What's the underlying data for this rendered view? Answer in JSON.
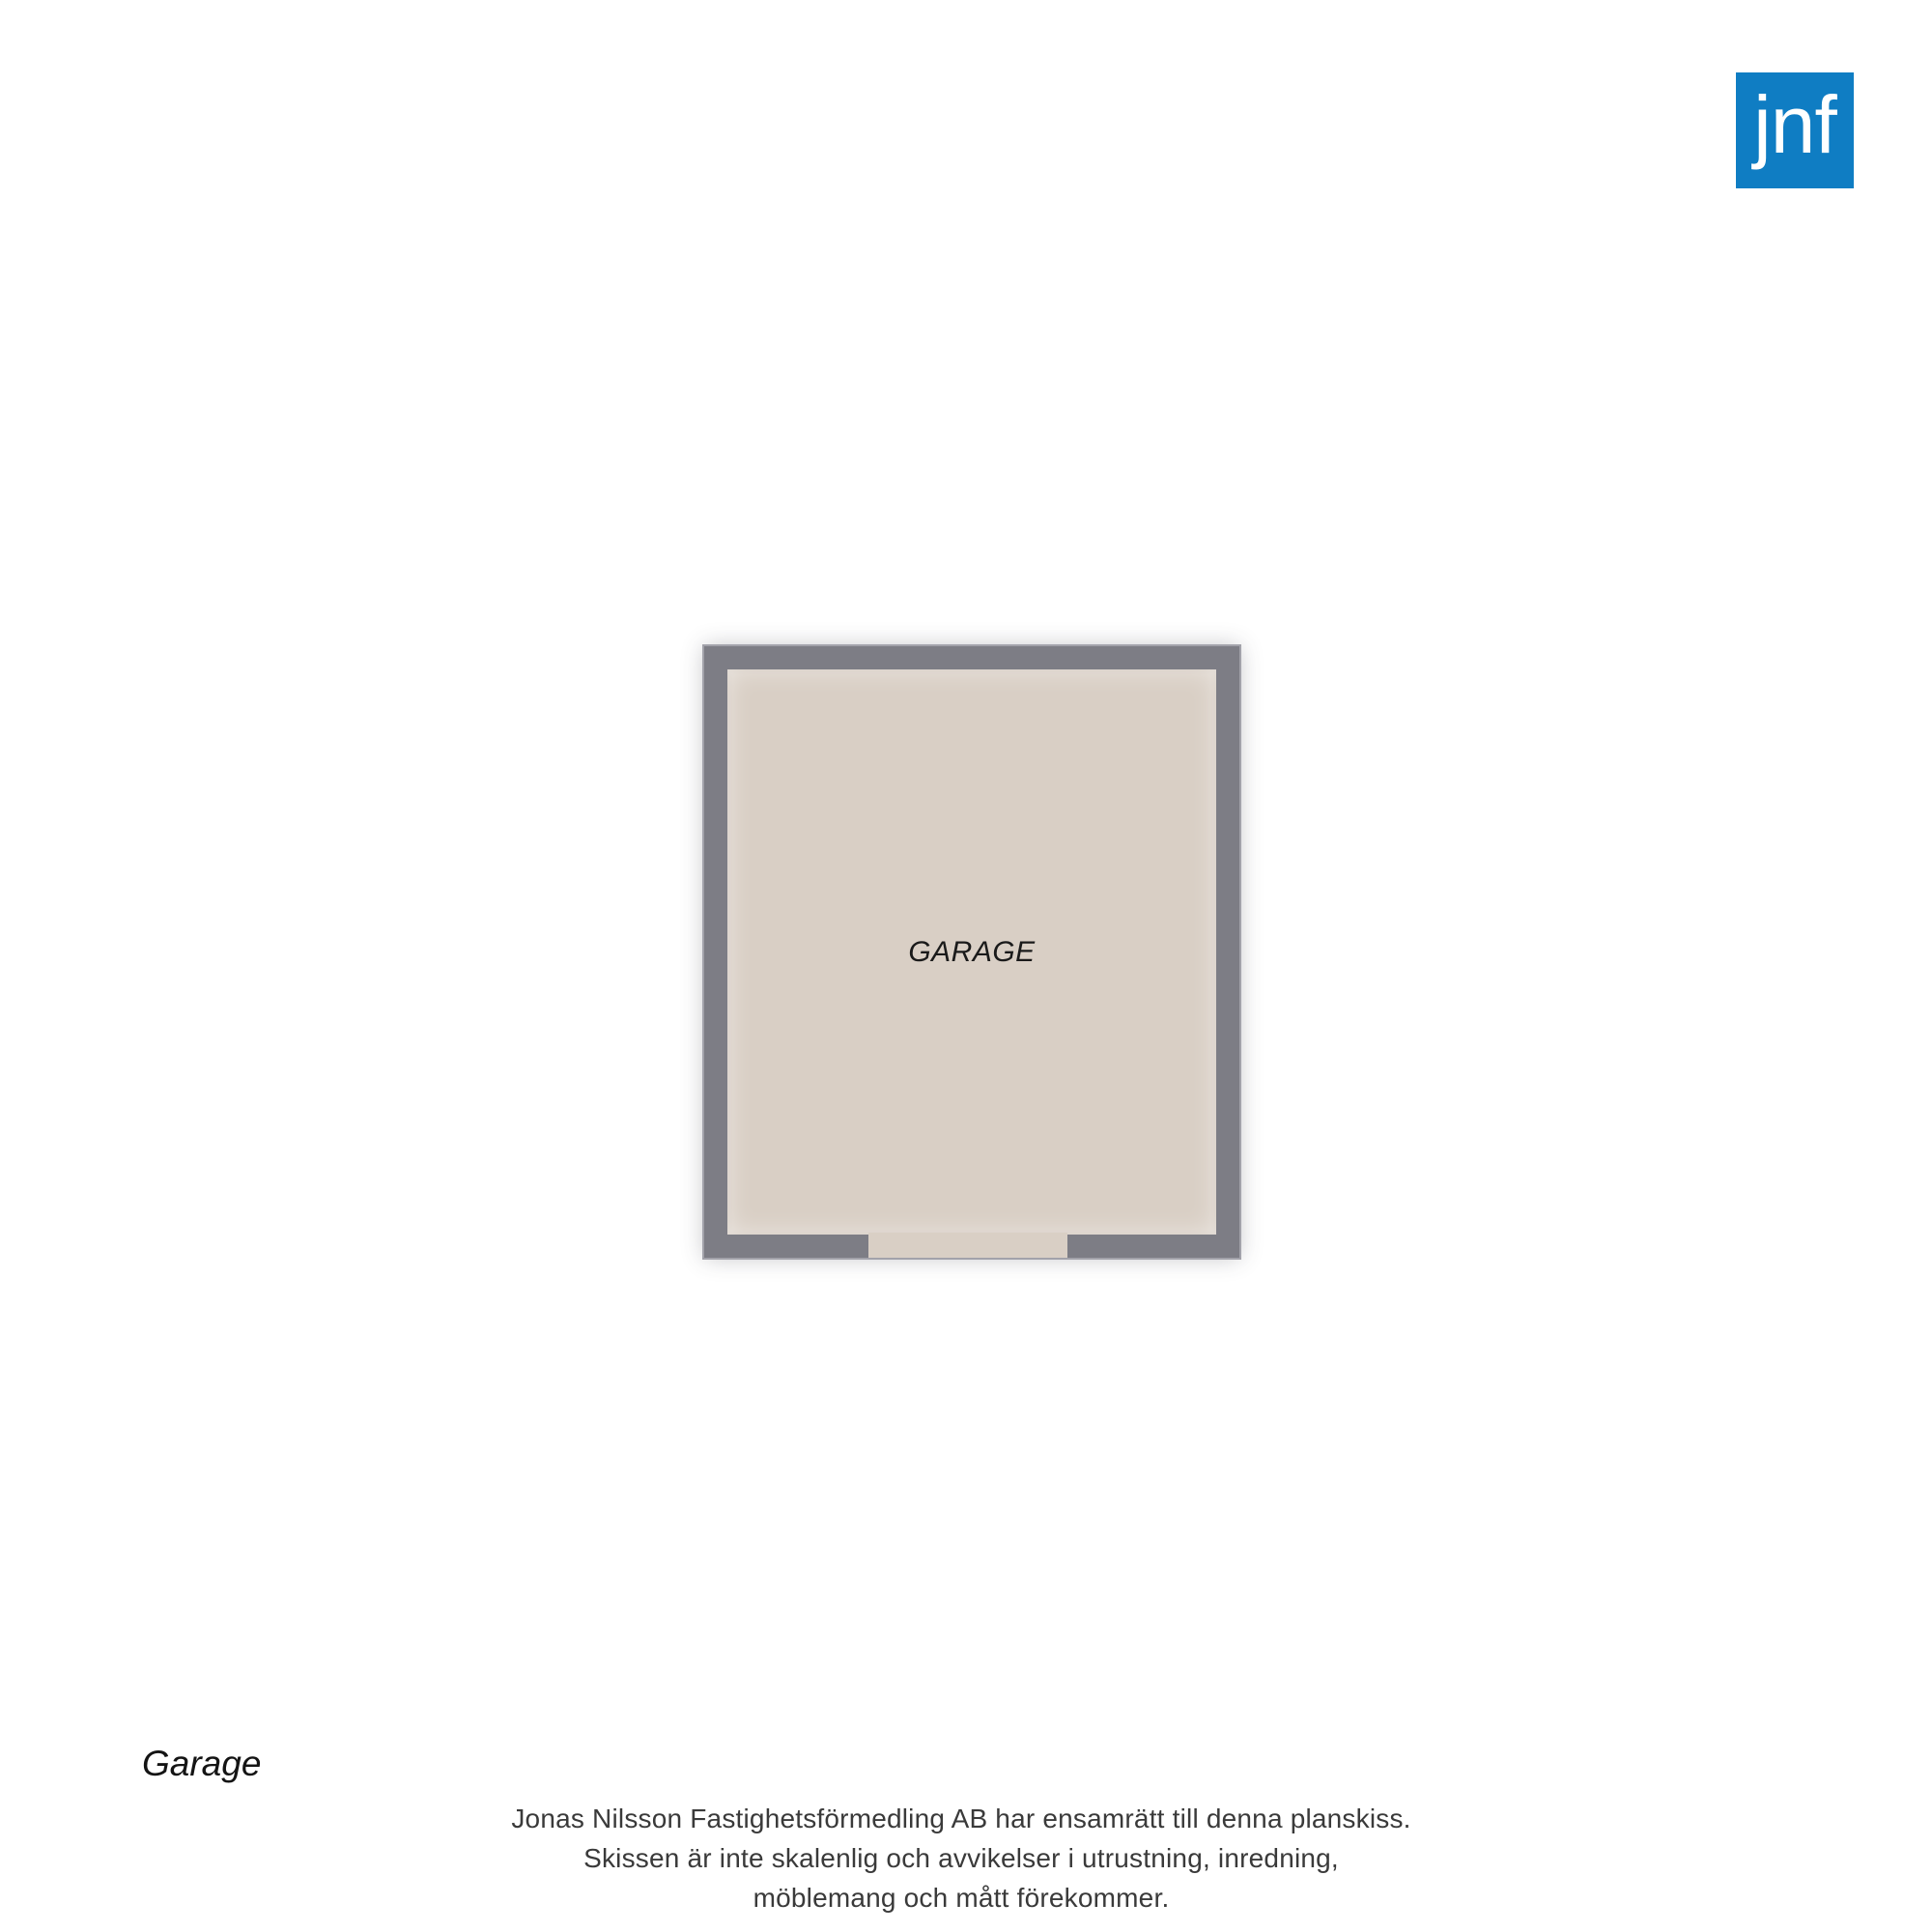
{
  "logo": {
    "text": "jnf",
    "background_color": "#0f7dc3",
    "text_color": "#ffffff"
  },
  "floorplan": {
    "room": {
      "label": "GARAGE"
    },
    "colors": {
      "wall": "#7d7d85",
      "floor": "#d9cfc5"
    }
  },
  "footer": {
    "floor_label": "Garage",
    "disclaimer_lines": [
      "Jonas Nilsson Fastighetsförmedling AB har ensamrätt till denna planskiss.",
      "Skissen är inte skalenlig och avvikelser i utrustning, inredning,",
      "möblemang och mått förekommer."
    ]
  }
}
